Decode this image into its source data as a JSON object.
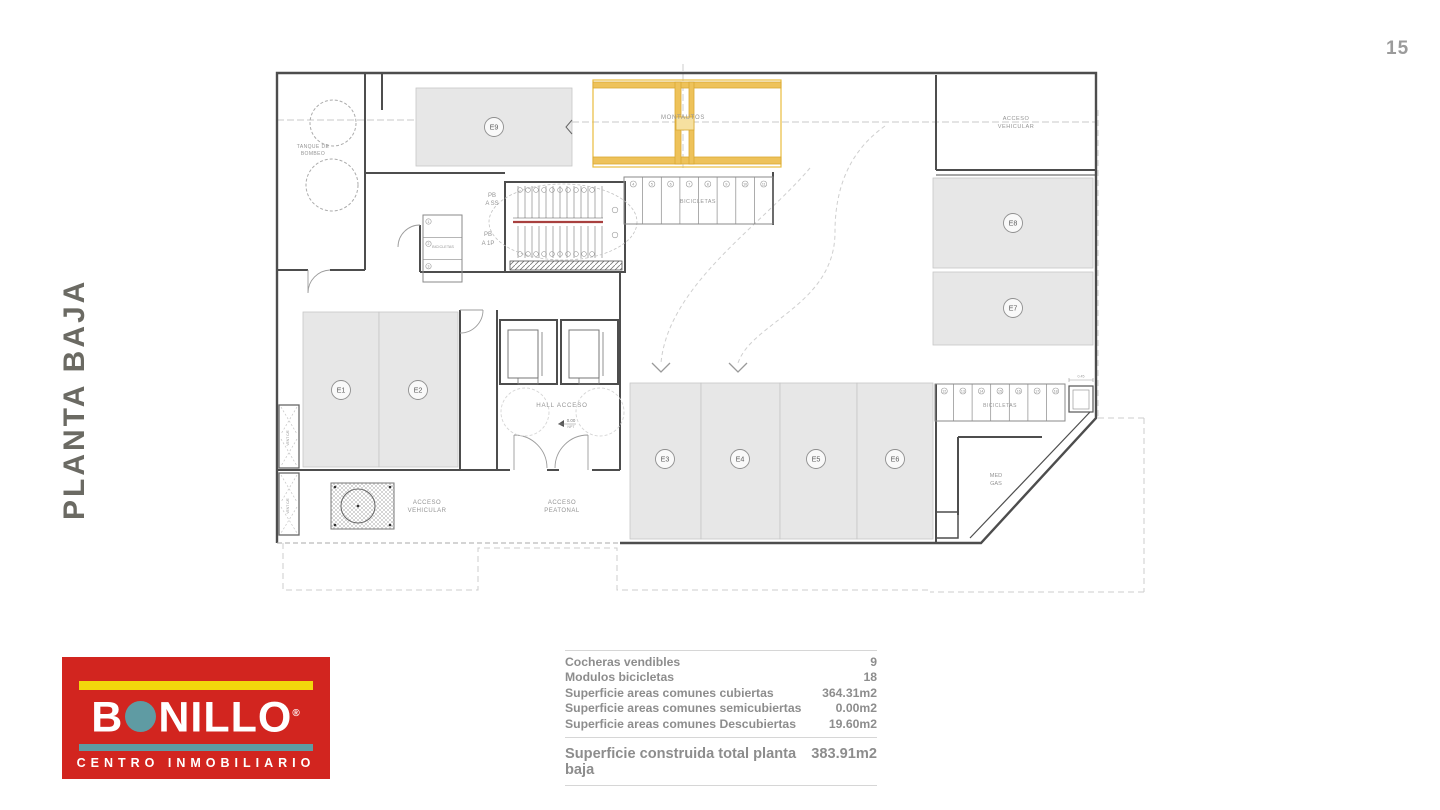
{
  "page": {
    "number": "15"
  },
  "sidebar_title": "PLANTA BAJA",
  "plan": {
    "spaces": [
      {
        "label": "E1"
      },
      {
        "label": "E2"
      },
      {
        "label": "E3"
      },
      {
        "label": "E4"
      },
      {
        "label": "E5"
      },
      {
        "label": "E6"
      },
      {
        "label": "E7"
      },
      {
        "label": "E8"
      },
      {
        "label": "E9"
      }
    ],
    "labels": {
      "tanque_line1": "TANQUE DE",
      "tanque_line2": "BOMBEO",
      "montautos": "MONTAUTOS",
      "bicicletas": "BICICLETAS",
      "acceso": "ACCESO",
      "vehicular": "VEHICULAR",
      "peatonal": "PEATONAL",
      "hall": "HALL ACCESO",
      "nivel": "0.00",
      "npt": "NPT",
      "pb": "PB",
      "a_ss": "A SS",
      "a_1p": "A 1P",
      "med": "MED",
      "gas": "GAS",
      "vent": "VENT C/E",
      "dim": "0.45"
    },
    "rack_numbers": {
      "left": [
        "1",
        "2",
        "3"
      ],
      "top": [
        "4",
        "5",
        "6",
        "7",
        "8",
        "9",
        "10",
        "11"
      ],
      "right": [
        "12",
        "13",
        "14",
        "15",
        "16",
        "17",
        "18"
      ]
    }
  },
  "summary": {
    "rows": [
      {
        "label": "Cocheras vendibles",
        "value": "9"
      },
      {
        "label": "Modulos bicicletas",
        "value": "18"
      },
      {
        "label": "Superficie areas comunes cubiertas",
        "value": "364.31m2"
      },
      {
        "label": "Superficie areas comunes semicubiertas",
        "value": "0.00m2"
      },
      {
        "label": "Superficie areas comunes Descubiertas",
        "value": "19.60m2"
      }
    ],
    "total": {
      "label": "Superficie construida total planta baja",
      "value": "383.91m2"
    }
  },
  "logo": {
    "brand_prefix": "B",
    "brand_suffix": "NILLO",
    "registered": "®",
    "tagline": "CENTRO INMOBILIARIO"
  },
  "colors": {
    "logo_red": "#d2251f",
    "logo_yellow": "#f2d70c",
    "logo_teal": "#5f9ba3",
    "montautos_yellow": "#e9bc3e",
    "fill_gray": "#e7e7e7",
    "title_gray": "#6b6a63"
  }
}
